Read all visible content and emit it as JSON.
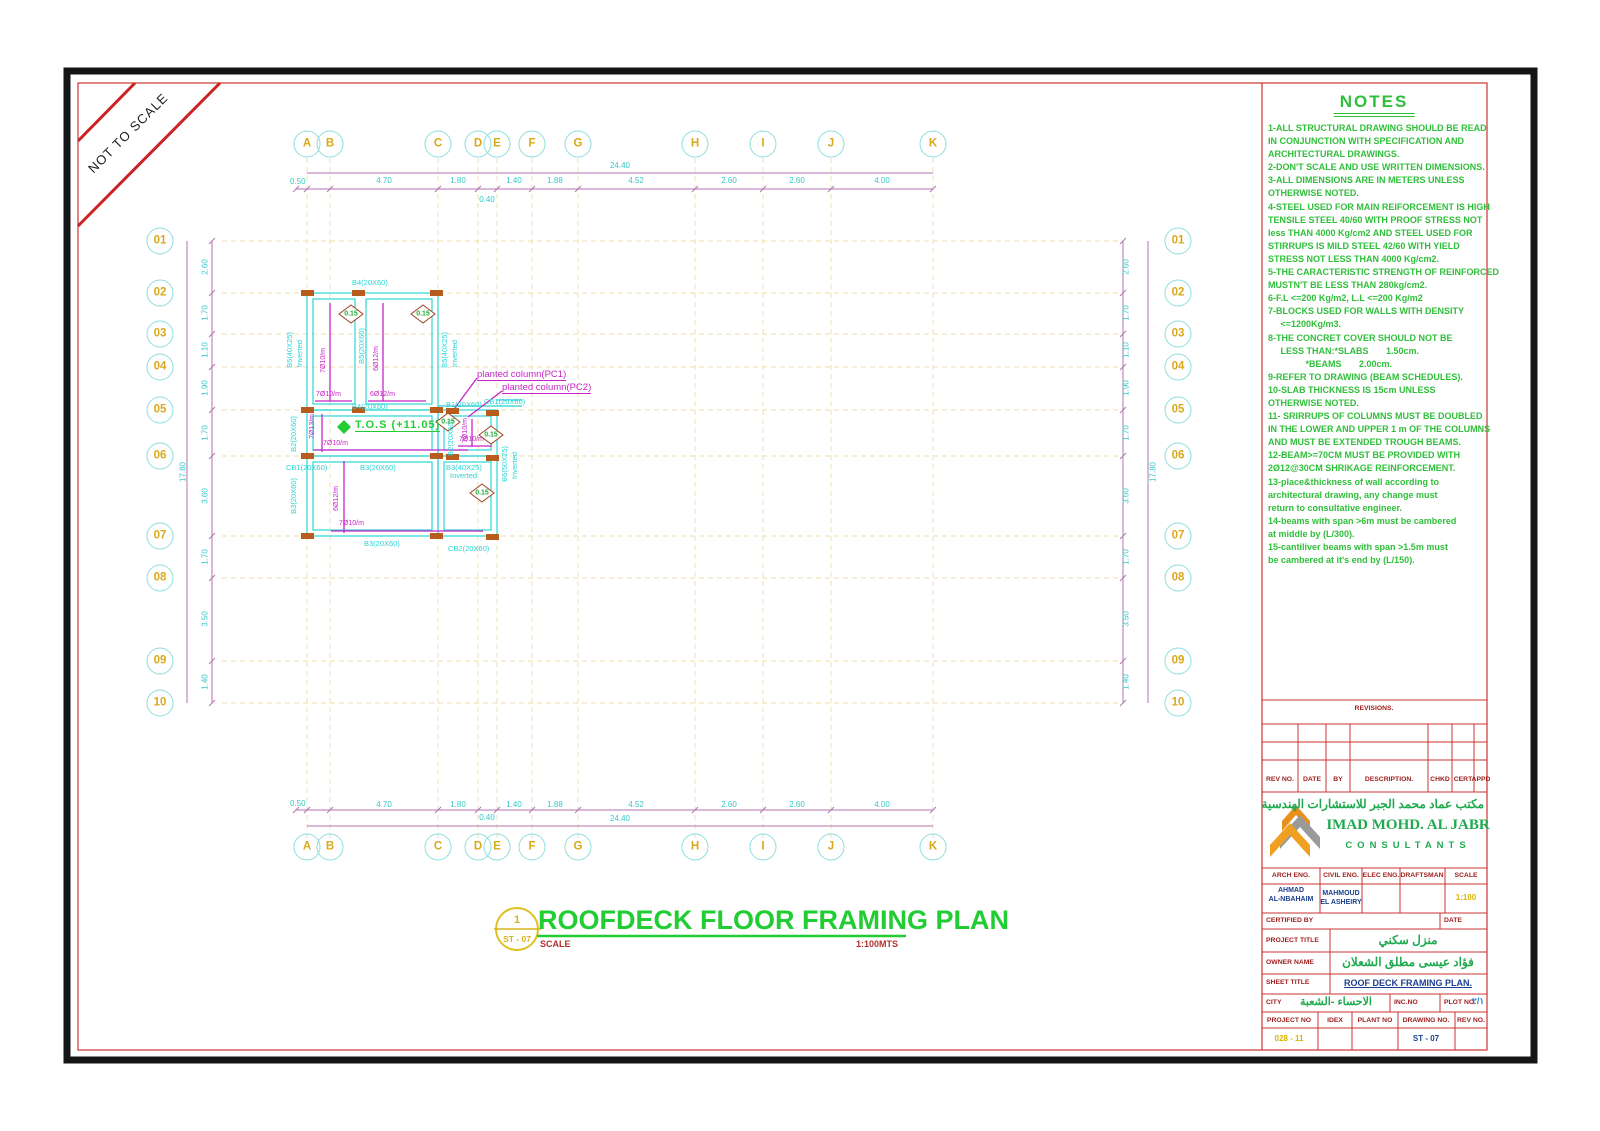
{
  "banner": {
    "label": "NOT TO SCALE"
  },
  "palette": {
    "cyan": "#2bd4d4",
    "yellow": "#d9a91c",
    "green": "#22cc33",
    "magenta": "#c824c8",
    "red": "#cc2222",
    "navy": "#1b3f8f",
    "orange": "#b85c1e"
  },
  "grid": {
    "top_letters": [
      {
        "label": "A",
        "x": 307
      },
      {
        "label": "B",
        "x": 330
      },
      {
        "label": "C",
        "x": 438
      },
      {
        "label": "D",
        "x": 478
      },
      {
        "label": "E",
        "x": 497
      },
      {
        "label": "F",
        "x": 532
      },
      {
        "label": "G",
        "x": 578
      },
      {
        "label": "H",
        "x": 695
      },
      {
        "label": "I",
        "x": 763
      },
      {
        "label": "J",
        "x": 831
      },
      {
        "label": "K",
        "x": 933
      }
    ],
    "bottom_letters": [
      {
        "label": "A",
        "x": 307
      },
      {
        "label": "B",
        "x": 330
      },
      {
        "label": "C",
        "x": 438
      },
      {
        "label": "D",
        "x": 478
      },
      {
        "label": "E",
        "x": 497
      },
      {
        "label": "F",
        "x": 532
      },
      {
        "label": "G",
        "x": 578
      },
      {
        "label": "H",
        "x": 695
      },
      {
        "label": "I",
        "x": 763
      },
      {
        "label": "J",
        "x": 831
      },
      {
        "label": "K",
        "x": 933
      }
    ],
    "left_rows": [
      {
        "label": "01",
        "y": 241
      },
      {
        "label": "02",
        "y": 293
      },
      {
        "label": "03",
        "y": 334
      },
      {
        "label": "04",
        "y": 367
      },
      {
        "label": "05",
        "y": 410
      },
      {
        "label": "06",
        "y": 456
      },
      {
        "label": "07",
        "y": 536
      },
      {
        "label": "08",
        "y": 578
      },
      {
        "label": "09",
        "y": 661
      },
      {
        "label": "10",
        "y": 703
      }
    ],
    "right_rows": [
      {
        "label": "01",
        "y": 241
      },
      {
        "label": "02",
        "y": 293
      },
      {
        "label": "03",
        "y": 334
      },
      {
        "label": "04",
        "y": 367
      },
      {
        "label": "05",
        "y": 410
      },
      {
        "label": "06",
        "y": 456
      },
      {
        "label": "07",
        "y": 536
      },
      {
        "label": "08",
        "y": 578
      },
      {
        "label": "09",
        "y": 661
      },
      {
        "label": "10",
        "y": 703
      }
    ]
  },
  "dims": {
    "top_segments": [
      {
        "label": "4.70",
        "x": 384
      },
      {
        "label": "1.80",
        "x": 458
      },
      {
        "label": "1.40",
        "x": 514
      },
      {
        "label": "1.88",
        "x": 555
      },
      {
        "label": "4.52",
        "x": 636
      },
      {
        "label": "2.60",
        "x": 729
      },
      {
        "label": "2.60",
        "x": 797
      },
      {
        "label": "4.00",
        "x": 882
      }
    ],
    "bottom_segments": [
      {
        "label": "4.70",
        "x": 384
      },
      {
        "label": "1.80",
        "x": 458
      },
      {
        "label": "1.40",
        "x": 514
      },
      {
        "label": "1.88",
        "x": 555
      },
      {
        "label": "4.52",
        "x": 636
      },
      {
        "label": "2.60",
        "x": 729
      },
      {
        "label": "2.60",
        "x": 797
      },
      {
        "label": "4.00",
        "x": 882
      }
    ],
    "left_segments": [
      {
        "label": "2.60",
        "y": 267
      },
      {
        "label": "1.70",
        "y": 313
      },
      {
        "label": "1.10",
        "y": 350
      },
      {
        "label": "1.90",
        "y": 388
      },
      {
        "label": "1.70",
        "y": 433
      },
      {
        "label": "3.60",
        "y": 496
      },
      {
        "label": "1.70",
        "y": 557
      },
      {
        "label": "3.50",
        "y": 619
      },
      {
        "label": "1.40",
        "y": 682
      }
    ],
    "right_segments": [
      {
        "label": "2.60",
        "y": 267
      },
      {
        "label": "1.70",
        "y": 313
      },
      {
        "label": "1.10",
        "y": 350
      },
      {
        "label": "1.90",
        "y": 388
      },
      {
        "label": "1.70",
        "y": 433
      },
      {
        "label": "3.60",
        "y": 496
      },
      {
        "label": "1.70",
        "y": 557
      },
      {
        "label": "3.50",
        "y": 619
      },
      {
        "label": "1.40",
        "y": 682
      }
    ],
    "top_total": "24.40",
    "bottom_total": "24.40",
    "left_total": "17.80",
    "right_total": "17.80",
    "top_first": "0.50",
    "bottom_first": "0.50",
    "top_sub": "0.40",
    "bottom_sub": "0.40"
  },
  "plan": {
    "beams": [
      {
        "label": "B4(20X60)",
        "x": 352,
        "y": 278
      },
      {
        "label": "B5(40X25)",
        "x": 285,
        "y": 332,
        "cls": "vlab"
      },
      {
        "label": "Inverted",
        "x": 295,
        "y": 340,
        "cls": "vlab"
      },
      {
        "label": "B5(20X60)",
        "x": 357,
        "y": 328,
        "cls": "vlab"
      },
      {
        "label": "B5(40X25)",
        "x": 440,
        "y": 332,
        "cls": "vlab"
      },
      {
        "label": "Inverted",
        "x": 450,
        "y": 340,
        "cls": "vlab"
      },
      {
        "label": "B4(20X60)",
        "x": 352,
        "y": 402
      },
      {
        "label": "B1(20X60)",
        "x": 446,
        "y": 400
      },
      {
        "label": "CB1(20X60)",
        "x": 484,
        "y": 397
      },
      {
        "label": "B2(20X60)",
        "x": 289,
        "y": 416,
        "cls": "vlab"
      },
      {
        "label": "B2(20X60)",
        "x": 446,
        "y": 420,
        "cls": "vlab"
      },
      {
        "label": "CB1(20X60)",
        "x": 286,
        "y": 463
      },
      {
        "label": "B3(20X60)",
        "x": 360,
        "y": 463
      },
      {
        "label": "B3(40X25)",
        "x": 446,
        "y": 463
      },
      {
        "label": "Inverted",
        "x": 450,
        "y": 471
      },
      {
        "label": "B3(20X60)",
        "x": 289,
        "y": 478,
        "cls": "vlab"
      },
      {
        "label": "B6(50X25)",
        "x": 500,
        "y": 446,
        "cls": "vlab"
      },
      {
        "label": "Inverted",
        "x": 510,
        "y": 452,
        "cls": "vlab"
      },
      {
        "label": "B3(20X60)",
        "x": 364,
        "y": 539
      },
      {
        "label": "CB2(20X60)",
        "x": 448,
        "y": 544
      }
    ],
    "rebar": [
      {
        "label": "7Ø10/m",
        "x": 320,
        "y": 348,
        "cls": "vlab"
      },
      {
        "label": "6Ø12/m",
        "x": 373,
        "y": 346,
        "cls": "vlab"
      },
      {
        "label": "7Ø10/m",
        "x": 316,
        "y": 391
      },
      {
        "label": "6Ø12/m",
        "x": 370,
        "y": 391
      },
      {
        "label": "7Ø13/m",
        "x": 309,
        "y": 414,
        "cls": "vlab"
      },
      {
        "label": "7Ø10/m",
        "x": 323,
        "y": 440
      },
      {
        "label": "7Ø10/m",
        "x": 462,
        "y": 418,
        "cls": "vlab"
      },
      {
        "label": "7Ø10/m",
        "x": 459,
        "y": 436
      },
      {
        "label": "6Ø12/m",
        "x": 333,
        "y": 486,
        "cls": "vlab"
      },
      {
        "label": "7Ø10/m",
        "x": 339,
        "y": 520
      }
    ],
    "diamonds": [
      {
        "label": "0.15",
        "x": 351,
        "y": 314
      },
      {
        "label": "0.15",
        "x": 423,
        "y": 314
      },
      {
        "label": "0.15",
        "x": 448,
        "y": 422
      },
      {
        "label": "0.15",
        "x": 491,
        "y": 435
      },
      {
        "label": "0.15",
        "x": 482,
        "y": 493
      }
    ],
    "callouts": [
      {
        "label": "planted column(PC1)",
        "x": 477,
        "y": 369
      },
      {
        "label": "planted column(PC2)",
        "x": 502,
        "y": 382
      }
    ],
    "tos_label": "T.O.S  (+11.05)"
  },
  "title": {
    "detail_number": "1",
    "detail_sheet": "ST - 07",
    "text": "ROOFDECK FLOOR FRAMING PLAN",
    "scale_label": "SCALE",
    "scale_value": "1:100MTS"
  },
  "notes": {
    "title": "NOTES",
    "lines": [
      "1-ALL STRUCTURAL DRAWING SHOULD BE READ",
      "IN CONJUNCTION WITH SPECIFICATION AND",
      "ARCHITECTURAL DRAWINGS.",
      "2-DON'T SCALE AND USE WRITTEN DIMENSIONS.",
      "3-ALL DIMENSIONS ARE IN METERS UNLESS",
      "OTHERWISE NOTED.",
      "4-STEEL USED FOR MAIN REIFORCEMENT IS HIGH",
      "TENSILE STEEL 40/60 WITH PROOF STRESS NOT",
      "less THAN 4000 Kg/cm2 AND STEEL USED FOR",
      "STIRRUPS IS MILD STEEL 42/60 WITH YIELD",
      "STRESS NOT LESS THAN 4000 Kg/cm2.",
      "5-THE CARACTERISTIC STRENGTH OF REINFORCED",
      "MUSTN'T BE LESS THAN 280kg/cm2.",
      "6-F.L <=200 Kg/m2, L.L <=200 Kg/m2",
      "7-BLOCKS USED FOR WALLS WITH DENSITY",
      "     <=1200Kg/m3.",
      "8-THE CONCRET COVER SHOULD NOT BE",
      "     LESS THAN:*SLABS       1.50cm.",
      "               *BEAMS       2.00cm.",
      "9-REFER TO DRAWING (BEAM SCHEDULES).",
      "10-SLAB THICKNESS IS 15cm UNLESS",
      "OTHERWISE NOTED.",
      "11- SRIRRUPS OF COLUMNS MUST BE DOUBLED",
      "IN THE LOWER AND UPPER 1 m OF THE COLUMNS",
      "AND MUST BE EXTENDED TROUGH BEAMS.",
      "12-BEAM>=70CM MUST BE PROVIDED WITH",
      "2Ø12@30CM SHRIKAGE REINFORCEMENT.",
      "13-place&thickness of wall according to",
      "architectural drawing, any change must",
      "return to consultative engineer.",
      "14-beams with span >6m must be cambered",
      "at middle by (L/300).",
      "15-cantiliver beams with span >1.5m must",
      "be cambered at it's end by (L/150)."
    ]
  },
  "titleblock": {
    "revisions_title": "REVISIONS.",
    "revisions_headers": [
      {
        "label": "REV NO.",
        "x": 1280
      },
      {
        "label": "DATE",
        "x": 1312
      },
      {
        "label": "BY",
        "x": 1338
      },
      {
        "label": "DESCRIPTION.",
        "x": 1389
      },
      {
        "label": "CHKD",
        "x": 1440
      },
      {
        "label": "CERT",
        "x": 1463
      },
      {
        "label": "APPD",
        "x": 1481
      }
    ],
    "company_arabic": "مكتب عماد محمد الجبر للاستشارات الهندسية",
    "company_name": "IMAD MOHD. AL JABR",
    "company_sub": "CONSULTANTS",
    "staff_headers": [
      {
        "label": "ARCH ENG.",
        "x": 1291
      },
      {
        "label": "CIVIL ENG.",
        "x": 1341
      },
      {
        "label": "ELEC ENG.",
        "x": 1381
      },
      {
        "label": "DRAFTSMAN",
        "x": 1422
      },
      {
        "label": "SCALE",
        "x": 1466
      }
    ],
    "arch_eng_1": "AHMAD",
    "arch_eng_2": "AL-NBAHAIM",
    "civil_eng_1": "MAHMOUD",
    "civil_eng_2": "EL ASHEIRY",
    "scale_value": "1:100",
    "certified_label": "CERTIFIED BY",
    "date_label": "DATE",
    "project_title_label": "PROJECT TITLE",
    "project_title_value": "منزل سكني",
    "owner_label": "OWNER NAME",
    "owner_value": "فؤاد عيسى مطلق الشعلان",
    "sheet_label": "SHEET TITLE",
    "sheet_value": "ROOF DECK FRAMING PLAN.",
    "city_label": "CITY",
    "city_value": "الاحساء -الشعبة",
    "incno_label": "INC.NO",
    "plot_label": "PLOT NO.",
    "plot_value": "٢/١",
    "bottom_headers": [
      {
        "label": "PROJECT NO",
        "x": 1289
      },
      {
        "label": "IDEX",
        "x": 1335
      },
      {
        "label": "PLANT NO",
        "x": 1375
      },
      {
        "label": "DRAWING NO.",
        "x": 1426
      },
      {
        "label": "REV NO.",
        "x": 1471
      }
    ],
    "project_no_value": "028 - 11",
    "drawing_no_value": "ST - 07"
  }
}
